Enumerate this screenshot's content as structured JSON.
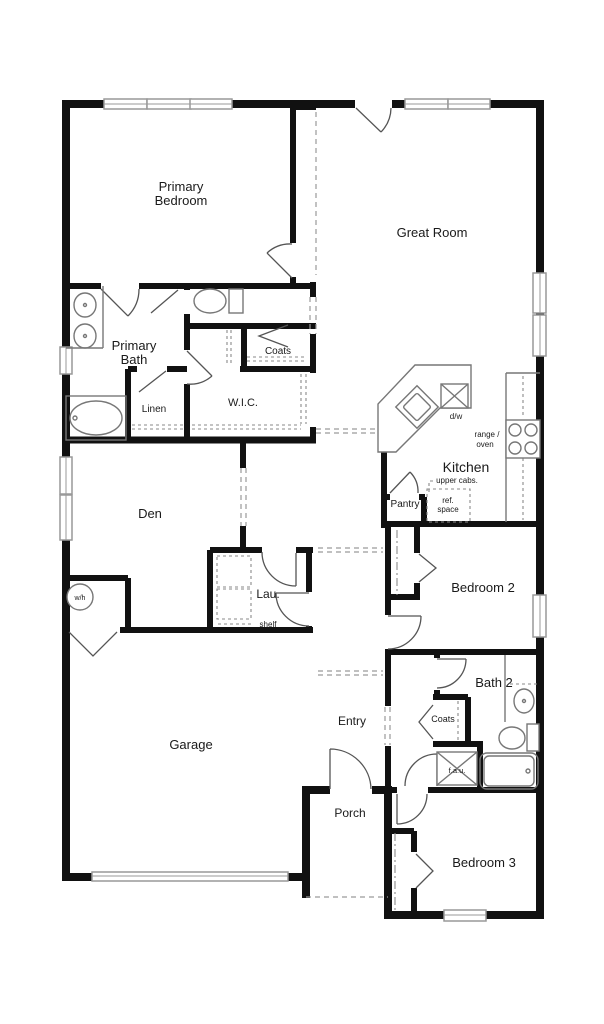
{
  "plan": {
    "rooms": {
      "primary_bedroom": {
        "label_line1": "Primary",
        "label_line2": "Bedroom"
      },
      "great_room": {
        "label": "Great Room"
      },
      "primary_bath": {
        "label_line1": "Primary",
        "label_line2": "Bath"
      },
      "coats_1": {
        "label": "Coats"
      },
      "wic": {
        "label": "W.I.C."
      },
      "linen": {
        "label": "Linen"
      },
      "den": {
        "label": "Den"
      },
      "kitchen": {
        "label": "Kitchen"
      },
      "pantry": {
        "label": "Pantry"
      },
      "laundry": {
        "label": "Lau."
      },
      "garage": {
        "label": "Garage"
      },
      "entry": {
        "label": "Entry"
      },
      "porch": {
        "label": "Porch"
      },
      "bedroom_2": {
        "label": "Bedroom 2"
      },
      "bath_2": {
        "label": "Bath 2"
      },
      "coats_2": {
        "label": "Coats"
      },
      "bedroom_3": {
        "label": "Bedroom 3"
      }
    },
    "annotations": {
      "dishwasher": "d/w",
      "range_line1": "range /",
      "range_line2": "oven",
      "upper_cabs": "upper cabs.",
      "ref_line1": "ref.",
      "ref_line2": "space",
      "shelf": "shelf",
      "water_heater": "w/h",
      "fau": "f.a.u."
    },
    "colors": {
      "wall": "#111111",
      "fixture": "#777777",
      "dashed": "#9a9a9a",
      "background": "#ffffff"
    }
  }
}
